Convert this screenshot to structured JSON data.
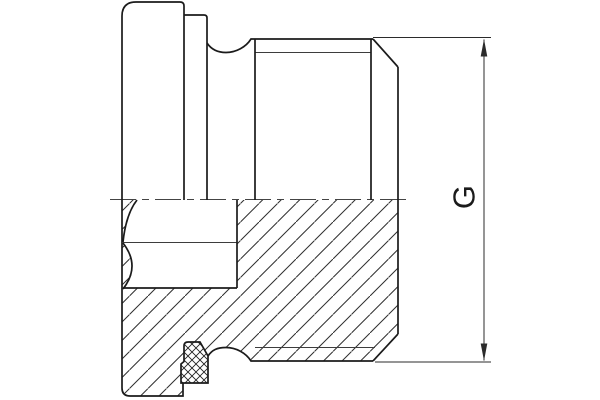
{
  "drawing": {
    "canvas": {
      "width": 600,
      "height": 400,
      "background": "#ffffff"
    },
    "colors": {
      "outline": "#1b1b1b",
      "thin_line": "#3d3d3d",
      "hatch": "#2e2e2e",
      "seal_hatch": "#222222",
      "dimension": "#2b2b2b",
      "centerline": "#444444"
    },
    "dimension": {
      "label": "G",
      "font_size": 31
    },
    "geometry": {
      "outline_paths": [
        "M122,200 L122,16 Q122,2 136,2 L180,2 Q184,2 184,6 L184,200",
        "M184,15 L204,15 Q207,15 207,18 L207,200",
        "M207,43 C211,49 217,52.5 226,52.5 C236,52.5 246,47 251,39 L253,39",
        "M253,39 L373,39",
        "M255,39 L255,200",
        "M371,39 L371,200",
        "M373,39 L398,67",
        "M398,67 L398,334",
        "M122,200 L122,388 Q122,396 130,396 L183,396 L183,383",
        "M208,356 C212,350 217,347.5 226,347.5 C236,347.5 246,353 251,361 L253,361",
        "M253,361 L373,361",
        "M373,361 L398,334",
        "M184,346 Q184,342 188,342 L200,342 L208,356 L208,383 L181,383 L181,364 L184,361.5 Z",
        "M137,200 Q126,214 123,242",
        "M123,243 Q141,266 123,289",
        "M123,288 L237,288",
        "M237,200 L237,288"
      ],
      "thin_paths": [
        "M255,52.5 L371,52.5",
        "M255,347.5 L375,347.5",
        "M123,242.5 L237,242.5"
      ],
      "centerline": {
        "d": "M110,199.5 L410,199.5",
        "dash": "26 6 7 6"
      },
      "dim_paths": [
        "M373,37.5 L491,37.5",
        "M375,362 L491,362",
        "M484,39.5 L484,360.5"
      ],
      "arrowheads": [
        "484,39 480.7,56.5 487.3,56.5",
        "484,361 480.7,343.5 487.3,343.5"
      ],
      "body_hatch_path": "M122,200 L122,388 Q122,396 130,396 L183,396 L183,383 L181,383 L181,364 L184,361.5 L184,346 Q184,342 188,342 L200,342 L208,356 C212,350 217,347.5 226,347.5 C236,347.5 246,353 251,361 L253,361 L373,361 L398,334 L398,200 Z M137,200 Q126,214 123,242 Q141,266 123,288 L237,288 L237,200 Z",
      "seal_hatch_path": "M184,346 Q184,342 188,342 L200,342 L208,356 L208,383 L181,383 L181,364 L184,361.5 Z"
    }
  }
}
